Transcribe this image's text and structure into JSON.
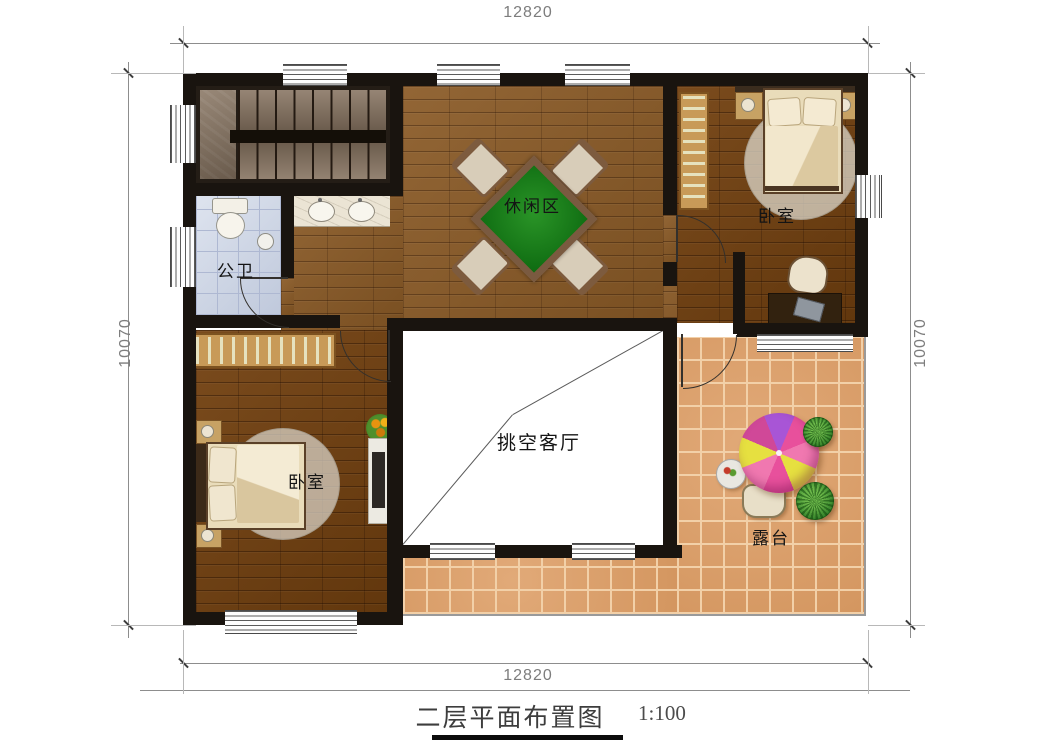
{
  "dimensions": {
    "top": "12820",
    "bottom": "12820",
    "left": "10070",
    "right": "10070"
  },
  "rooms": {
    "leisure": {
      "label": "休闲区"
    },
    "bedroom_right": {
      "label": "卧室"
    },
    "bedroom_left": {
      "label": "卧室"
    },
    "bathroom": {
      "label": "公卫"
    },
    "void": {
      "label": "挑空客厅"
    },
    "terrace": {
      "label": "露台"
    }
  },
  "title": {
    "text": "二层平面布置图",
    "scale": "1:100"
  },
  "colors": {
    "wall": "#19140f",
    "hall_wood": "#8a5a26",
    "bedroom_wood": "#72400f",
    "bath_tile": "#ccd5e6",
    "terrace_tile": "#dea069",
    "table_felt": "#187a18",
    "stair_marble": "#877461",
    "parasol_pink": "#e8509c",
    "parasol_purple": "#a855d6",
    "parasol_yellow": "#e6e040",
    "void_floor": "#ffffff"
  }
}
